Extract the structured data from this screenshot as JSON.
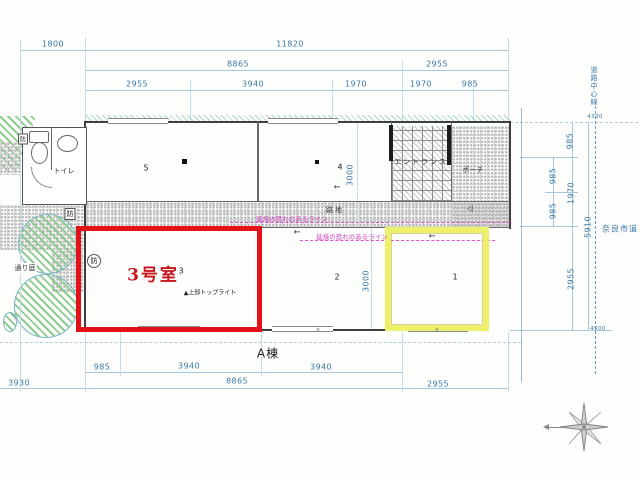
{
  "meta": {
    "drawing_type": "site-floor-plan",
    "building_label": "A棟"
  },
  "colors": {
    "dimension_text_blue": "#3878a8",
    "dimension_line_blue": "#a5c8de",
    "highlight_red": "#e31219",
    "room3_stamp_red": "#c9151c",
    "highlight_yellow": "#eef06a",
    "fire_line_magenta": "#d43fc4",
    "garden_green": "#8ecb92",
    "wall_dark": "#3f3f3f"
  },
  "dim_labels": [
    {
      "name": "dim-top-1800",
      "text": "1800",
      "x": 53,
      "y": 44
    },
    {
      "name": "dim-top-11820",
      "text": "11820",
      "x": 290,
      "y": 44
    },
    {
      "name": "dim-top-8865",
      "text": "8865",
      "x": 238,
      "y": 64
    },
    {
      "name": "dim-top-2955-right",
      "text": "2955",
      "x": 437,
      "y": 64
    },
    {
      "name": "dim-top-2955",
      "text": "2955",
      "x": 137,
      "y": 84
    },
    {
      "name": "dim-top-3940",
      "text": "3940",
      "x": 253,
      "y": 84
    },
    {
      "name": "dim-top-1970-a",
      "text": "1970",
      "x": 356,
      "y": 84
    },
    {
      "name": "dim-top-1970-b",
      "text": "1970",
      "x": 421,
      "y": 84
    },
    {
      "name": "dim-top-985",
      "text": "985",
      "x": 470,
      "y": 84
    },
    {
      "name": "dim-right-985-a",
      "text": "985",
      "x": 570,
      "y": 141,
      "v": true
    },
    {
      "name": "dim-right-985-b",
      "text": "985",
      "x": 553,
      "y": 176,
      "v": true
    },
    {
      "name": "dim-right-1970",
      "text": "1970",
      "x": 571,
      "y": 193,
      "v": true
    },
    {
      "name": "dim-right-985-c",
      "text": "985",
      "x": 553,
      "y": 211,
      "v": true
    },
    {
      "name": "dim-right-5910",
      "text": "5910",
      "x": 588,
      "y": 227,
      "v": true
    },
    {
      "name": "dim-right-2955",
      "text": "2955",
      "x": 571,
      "y": 279,
      "v": true
    },
    {
      "name": "dim-level-4330",
      "text": "4330",
      "x": 595,
      "y": 117,
      "cls": "dim dim-tiny"
    },
    {
      "name": "dim-level-4500",
      "text": "4500",
      "x": 598,
      "y": 329,
      "cls": "dim dim-tiny"
    },
    {
      "name": "dim-room4-3000",
      "text": "3000",
      "x": 350,
      "y": 175,
      "v": true
    },
    {
      "name": "dim-room2-3000",
      "text": "3000",
      "x": 366,
      "y": 281,
      "v": true
    },
    {
      "name": "dim-bot-985",
      "text": "985",
      "x": 102,
      "y": 367
    },
    {
      "name": "dim-bot-3940-a",
      "text": "3940",
      "x": 189,
      "y": 366
    },
    {
      "name": "dim-bot-3940-b",
      "text": "3940",
      "x": 321,
      "y": 367
    },
    {
      "name": "dim-bot-3930",
      "text": "3930",
      "x": 19,
      "y": 383
    },
    {
      "name": "dim-bot-8865",
      "text": "8865",
      "x": 237,
      "y": 381
    },
    {
      "name": "dim-bot-2955",
      "text": "2955",
      "x": 438,
      "y": 384
    }
  ],
  "text_labels": [
    {
      "name": "label-toilet",
      "text": "トイレ",
      "x": 64,
      "y": 171,
      "cls": "jp"
    },
    {
      "name": "label-entrance",
      "text": "エントランス",
      "x": 421,
      "y": 162,
      "cls": "jp-spaced"
    },
    {
      "name": "label-porch",
      "text": "ポーチ",
      "x": 473,
      "y": 170,
      "cls": "jp"
    },
    {
      "name": "label-alley",
      "text": "路地",
      "x": 335,
      "y": 210,
      "cls": "jp-spaced"
    },
    {
      "name": "label-passage-garden",
      "text": "通り庭",
      "x": 25,
      "y": 268,
      "cls": "jp-bg"
    },
    {
      "name": "label-building-a",
      "text": "A棟",
      "x": 268,
      "y": 353,
      "cls": "building"
    },
    {
      "name": "label-nara-city-road",
      "text": "奈良市道",
      "x": 620,
      "y": 229,
      "cls": "road"
    },
    {
      "name": "label-road-centerline",
      "text": "道路中心線",
      "x": 594,
      "y": 86,
      "cls": "road-vert"
    },
    {
      "name": "label-fire-spread-line-1",
      "text": "延焼の恐れのあるライン",
      "x": 292,
      "y": 218,
      "cls": "magenta"
    },
    {
      "name": "label-fire-spread-line-2",
      "text": "延焼の恐れのあるライン",
      "x": 352,
      "y": 236,
      "cls": "magenta"
    },
    {
      "name": "label-toplight",
      "text": "▲上部トップライト",
      "x": 210,
      "y": 292,
      "cls": "tiny-black"
    },
    {
      "name": "label-room3-stamp",
      "text": "3号室",
      "x": 153,
      "y": 273,
      "cls": "stamp"
    },
    {
      "name": "room-num-5",
      "text": "5",
      "x": 146,
      "y": 168,
      "cls": "num"
    },
    {
      "name": "room-num-4",
      "text": "4",
      "x": 340,
      "y": 167,
      "cls": "num"
    },
    {
      "name": "room-num-3",
      "text": "3",
      "x": 181,
      "y": 271,
      "cls": "num"
    },
    {
      "name": "room-num-2",
      "text": "2",
      "x": 337,
      "y": 277,
      "cls": "num"
    },
    {
      "name": "room-num-1",
      "text": "1",
      "x": 455,
      "y": 277,
      "cls": "num"
    },
    {
      "name": "fireproof-mark-1",
      "text": "防",
      "x": 23,
      "y": 139,
      "cls": "bou-sq-sm"
    },
    {
      "name": "fireproof-mark-2",
      "text": "防",
      "x": 70,
      "y": 214,
      "cls": "bou-sq"
    },
    {
      "name": "fireproof-mark-3",
      "text": "防",
      "x": 94,
      "y": 261,
      "cls": "bou-ci"
    },
    {
      "name": "door-arrow-room4",
      "text": "←",
      "x": 337,
      "y": 187,
      "cls": "arr"
    },
    {
      "name": "door-arrow-room2",
      "text": "←",
      "x": 297,
      "y": 232,
      "cls": "arr"
    },
    {
      "name": "door-arrow-room1",
      "text": "←",
      "x": 432,
      "y": 236,
      "cls": "arr"
    },
    {
      "name": "door-swing-porch",
      "text": "◁",
      "x": 470,
      "y": 208,
      "cls": "arr"
    },
    {
      "name": "wall-mark-a",
      "text": "×",
      "x": 318,
      "y": 330,
      "cls": "cross"
    },
    {
      "name": "wall-mark-b",
      "text": "×",
      "x": 437,
      "y": 330,
      "cls": "cross"
    }
  ]
}
